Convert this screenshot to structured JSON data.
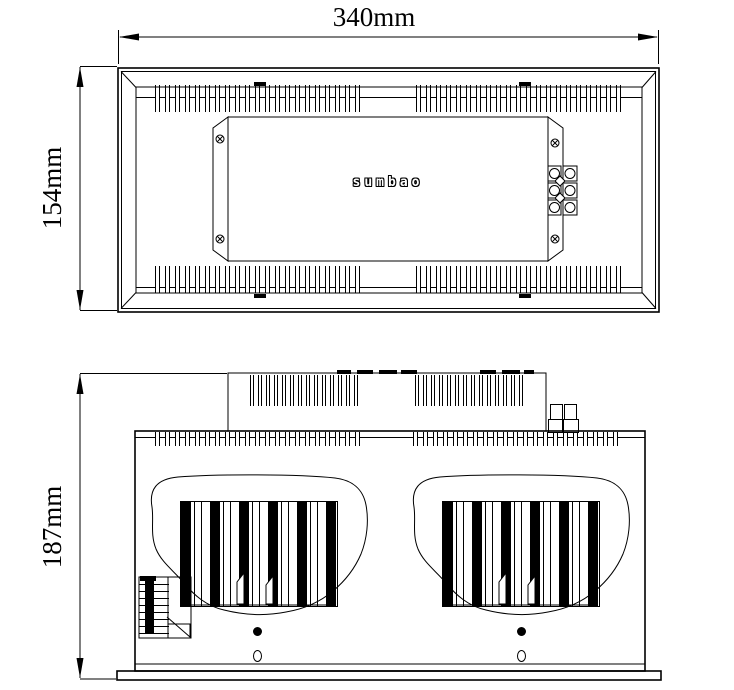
{
  "drawing": {
    "background_color": "#ffffff",
    "line_color": "#000000",
    "logo_text": "sumbao",
    "dimensions": {
      "overall_width": "340mm",
      "overall_depth": "154mm",
      "overall_height": "187mm"
    }
  }
}
